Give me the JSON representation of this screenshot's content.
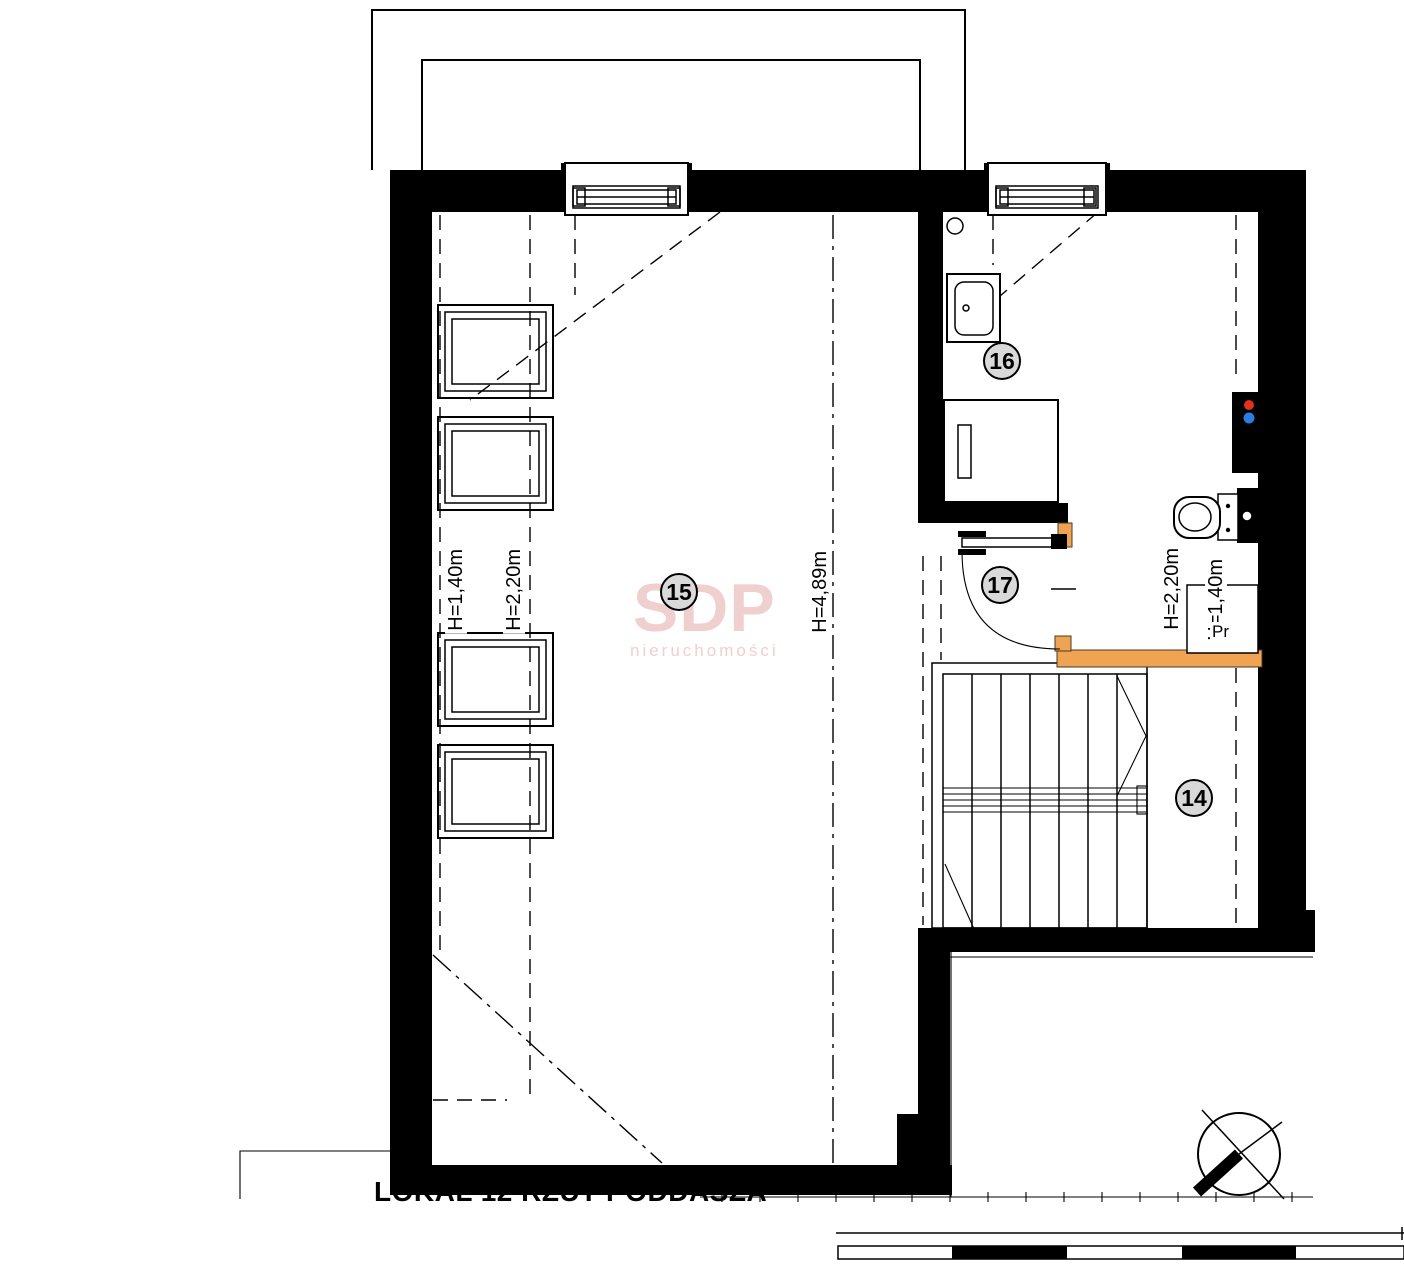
{
  "drawing": {
    "title": "LOKAL 12 RZUT PODDASZA"
  },
  "watermark": {
    "brand": "SDP",
    "subtitle": "nieruchomości"
  },
  "rooms": {
    "r14": "14",
    "r15": "15",
    "r16": "16",
    "r17": "17"
  },
  "heights": {
    "left_low": "H=1,40m",
    "left_mid": "H=2,20m",
    "center": "H=4,89m",
    "right_mid": "H=2,20m",
    "right_low": "H=1,40m"
  },
  "annotations": {
    "pr": "Pr"
  },
  "colors": {
    "wall": "#000000",
    "wood_accent": "#efa353",
    "badge_fill": "#d9d9d9",
    "watermark_pink": "#f0cfcf",
    "hot_water_red": "#e2321c",
    "cold_water_blue": "#2b7de0"
  }
}
